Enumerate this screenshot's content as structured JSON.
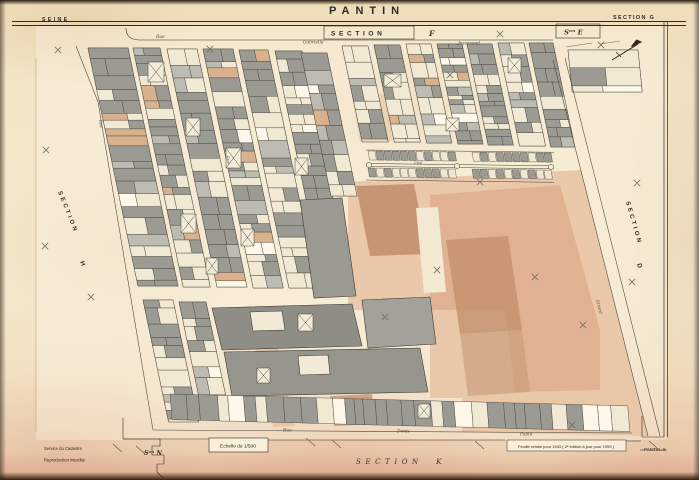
{
  "header": {
    "department": "SEINE",
    "title": "PANTIN",
    "sheet_ref": "SECTION G"
  },
  "adjacent_sections": {
    "north_word": "SECTION",
    "north_letter": "F",
    "north_east": "Sᵒⁿ E",
    "west_word": "SECTION",
    "west_letter": "H",
    "east_word": "SECTION",
    "east_letter": "D",
    "south_word": "SECTION",
    "south_letter": "K",
    "south_west": "Sᵒⁿ N"
  },
  "streets": {
    "north_rue": "Rue",
    "north_name1": "Gabrielle",
    "north_name2": "Josserand",
    "south_rue": "Rue",
    "south_name1": "Denis",
    "south_name2": "Papin",
    "east_name": "Girard",
    "west_rue": "Rue",
    "inner_rue": "Rue",
    "cite_label": "Cité"
  },
  "footer": {
    "office_line1": "Service du Cadastre",
    "office_line2": "Reproduction interdite",
    "scale_label": "Echelle de 1/500",
    "revision_note": "Feuille refaite pour 1943 ( 2ᵉ édition à jour pour 1959 )",
    "corner_ref": "PANTIN. 5"
  },
  "colors": {
    "paper": "#f3e5c8",
    "ink": "#35312a",
    "building_gray": "#9b9b94",
    "wash_salmon": "#e3b593",
    "wash_brown": "#bf8e6a",
    "wash_pink": "#e9c9ba"
  }
}
